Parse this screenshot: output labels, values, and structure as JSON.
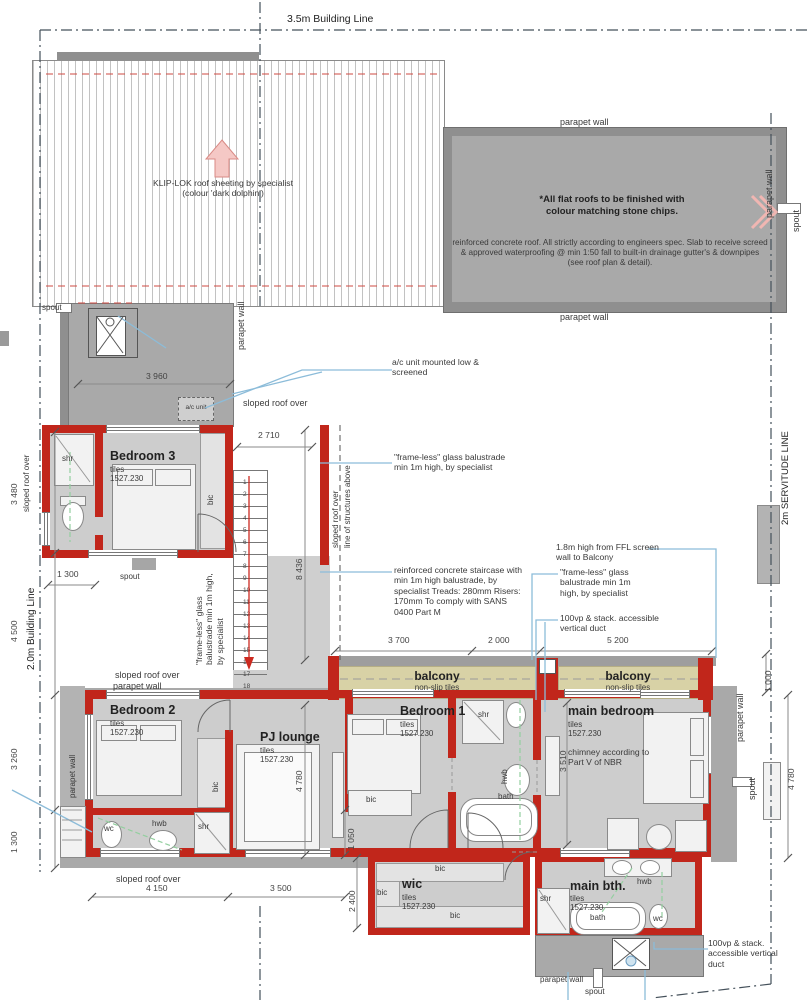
{
  "lines": {
    "top": "3.5m Building Line",
    "left": "2.0m Building Line",
    "right": "2m SERVITUDE LINE"
  },
  "roof": {
    "klip": "KLIP-LOK roof sheeting by specialist (colour 'dark dolphin')",
    "flat_title": "*All flat roofs to be finished with colour matching stone chips.",
    "flat_body": "reinforced concrete roof.  All strictly according to engineers spec. Slab to receive screed & approved waterproofing @ min 1:50 fall to built-in drainage gutter's & downpipes (see roof plan & detail).",
    "parapet": "parapet wall",
    "spout": "spout",
    "sloped": "sloped roof over",
    "structures": "line of structures above"
  },
  "notes": {
    "ac_box": "a/c unit",
    "ac": "a/c unit mounted low & screened",
    "balustrade": "\"frame-less\" glass balustrade min 1m high, by specialist",
    "stair": "reinforced concrete staircase with min 1m high balustrade, by specialist Treads: 280mm Risers: 170mm To comply with SANS 0400 Part M",
    "screen": "1.8m high from FFL screen wall to Balcony",
    "duct": "100vp &  stack. accessible vertical duct",
    "chimney": "chimney according to Part V of NBR"
  },
  "rooms": {
    "bedroom3": {
      "name": "Bedroom 3"
    },
    "bedroom2": {
      "name": "Bedroom 2"
    },
    "bedroom1": {
      "name": "Bedroom 1"
    },
    "main_bedroom": {
      "name": "main bedroom"
    },
    "pj_lounge": {
      "name": "PJ lounge"
    },
    "wic": {
      "name": "wic"
    },
    "main_bath": {
      "name": "main bth."
    },
    "finish": "tiles",
    "code": "1527.230",
    "balcony": "balcony",
    "balcony_finish": "non-slip tiles"
  },
  "fixtures": {
    "shr": "shr",
    "wc": "wc",
    "hwb": "hwb",
    "bath": "bath",
    "bic": "bic"
  },
  "dims": {
    "d3960": "3 960",
    "d2710": "2 710",
    "d8436": "8 436",
    "d3480": "3 480",
    "d1300": "1 300",
    "d4500": "4 500",
    "d3260": "3 260",
    "d3700": "3 700",
    "d2000": "2 000",
    "d5200": "5 200",
    "d1000": "1 000",
    "d4780": "4 780",
    "d3510": "3 510",
    "d1050": "1 050",
    "d4150": "4 150",
    "d3500": "3 500",
    "d2400": "2 400"
  },
  "stairs": {
    "numbers": [
      1,
      2,
      3,
      4,
      5,
      6,
      7,
      8,
      9,
      10,
      11,
      12,
      13,
      14,
      15,
      16,
      17,
      18
    ]
  }
}
